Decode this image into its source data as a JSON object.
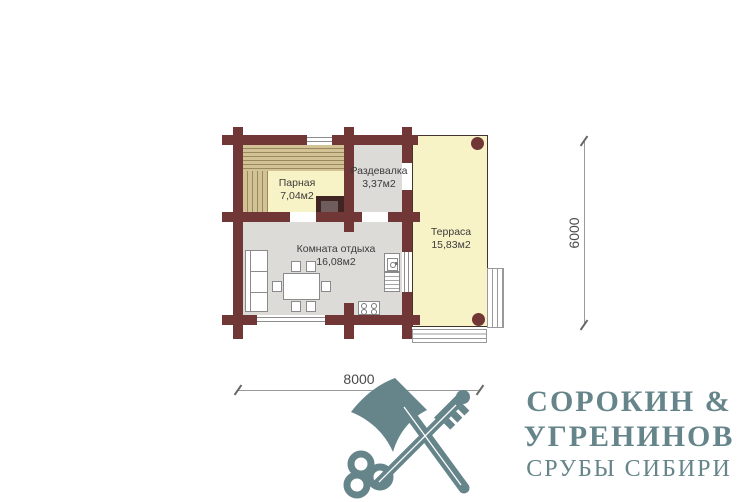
{
  "plan": {
    "rooms": [
      {
        "id": "parnaya",
        "name": "Парная",
        "area": "7,04м2"
      },
      {
        "id": "razdevalka",
        "name": "Раздевалка",
        "area": "3,37м2"
      },
      {
        "id": "komnata",
        "name": "Комната отдыха",
        "area": "16,08м2"
      },
      {
        "id": "terrasa",
        "name": "Терраса",
        "area": "15,83м2"
      }
    ],
    "dimensions": {
      "width_mm": "8000",
      "height_mm": "6000"
    }
  },
  "logo": {
    "title_line1": "СОРОКИН  &",
    "title_line2": "УГРЕНИНОВ",
    "subtitle": "СРУБЫ СИБИРИ",
    "icon": "axe-and-key-icon",
    "color": "#66858a"
  },
  "colors": {
    "wall": "#713736",
    "floor_warm": "#f8f3c6",
    "floor_gray": "#dcdbd8",
    "bench": "#d3c295"
  }
}
